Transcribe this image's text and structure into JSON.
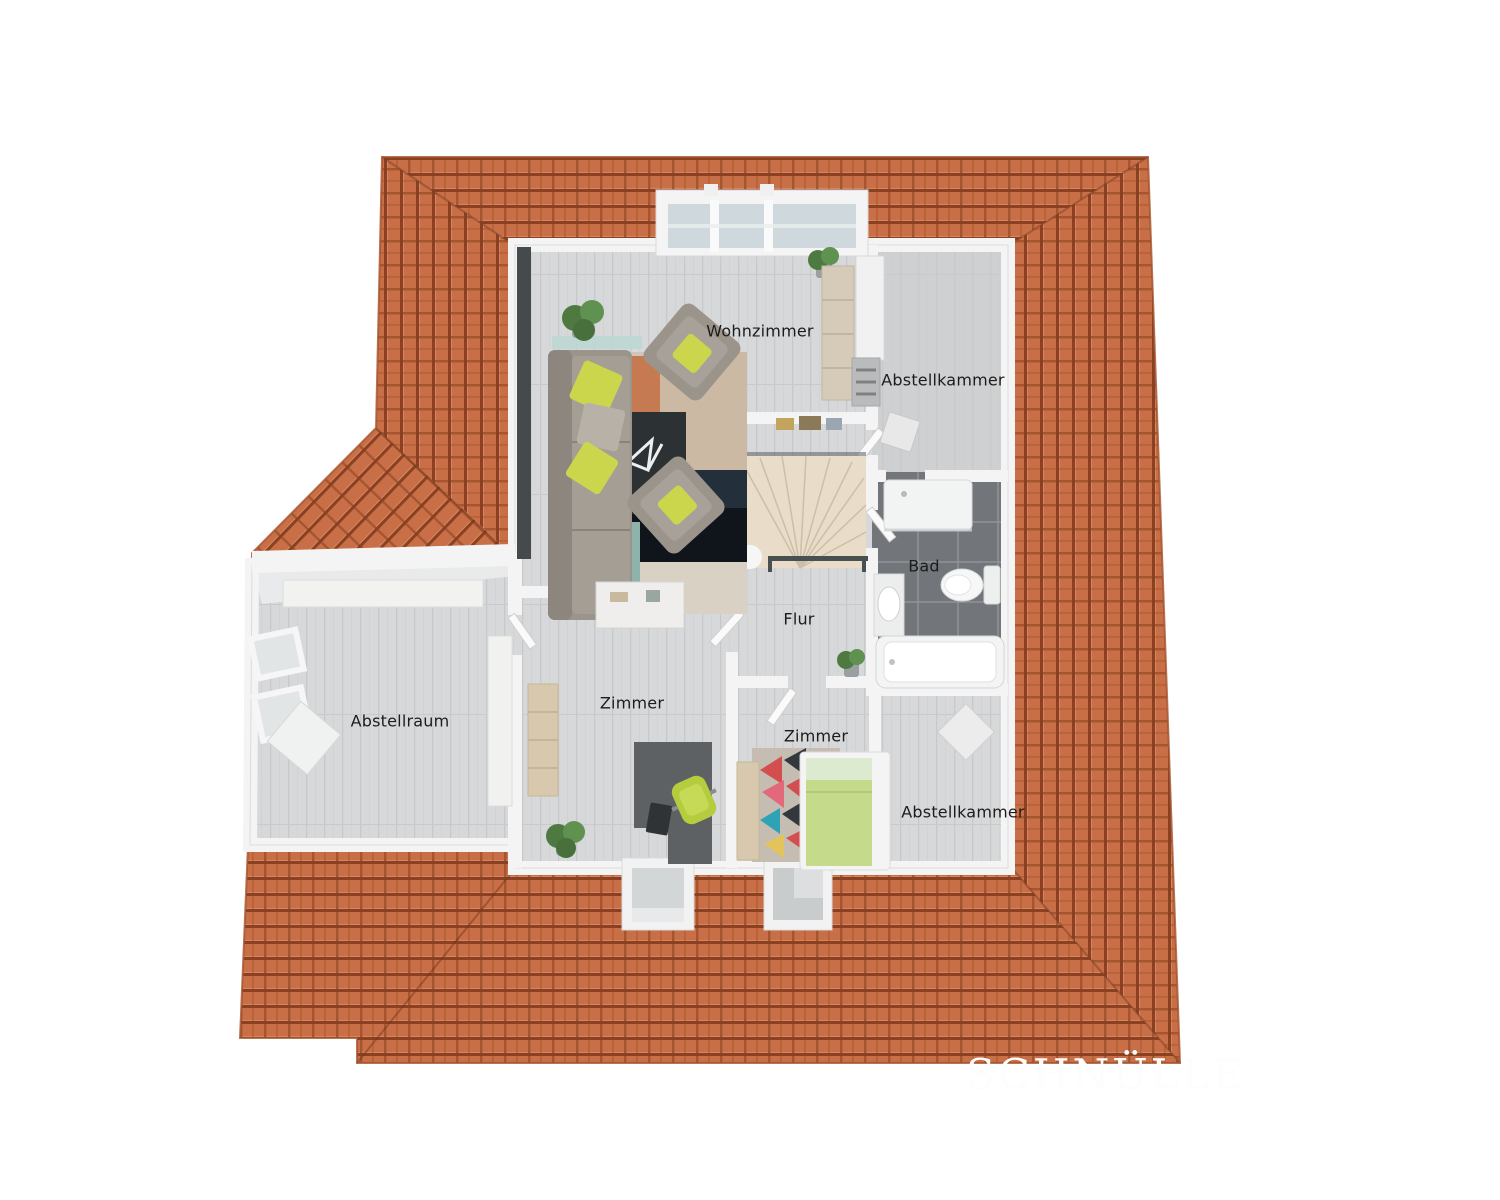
{
  "scene": {
    "type": "3d-floor-plan-top-view",
    "description": "Attic storey floor plan surrounded by orange hip roof"
  },
  "rooms": [
    {
      "id": "wohnzimmer",
      "label": "Wohnzimmer"
    },
    {
      "id": "abstellkammer_top",
      "label": "Abstellkammer"
    },
    {
      "id": "bad",
      "label": "Bad"
    },
    {
      "id": "flur",
      "label": "Flur"
    },
    {
      "id": "zimmer_left",
      "label": "Zimmer"
    },
    {
      "id": "zimmer_bottom",
      "label": "Zimmer"
    },
    {
      "id": "abstellraum",
      "label": "Abstellraum"
    },
    {
      "id": "abstellkammer_bottom",
      "label": "Abstellkammer"
    }
  ],
  "watermark": {
    "text": "SCHNÜLLE"
  },
  "palette": {
    "roof_tile": "#c86f48",
    "roof_gap": "#8a4122",
    "roof_edge": "#a4522c",
    "floor_wood": "#d7d8d9",
    "wall_white": "#f4f4f4",
    "bath_floor": "#72767a",
    "stair_beige": "#e9ddc9",
    "accent_lime": "#ccd64c",
    "bed_green": "#c6da8c",
    "sofa_gray": "#9b948b",
    "desk_gray": "#5d6164"
  }
}
